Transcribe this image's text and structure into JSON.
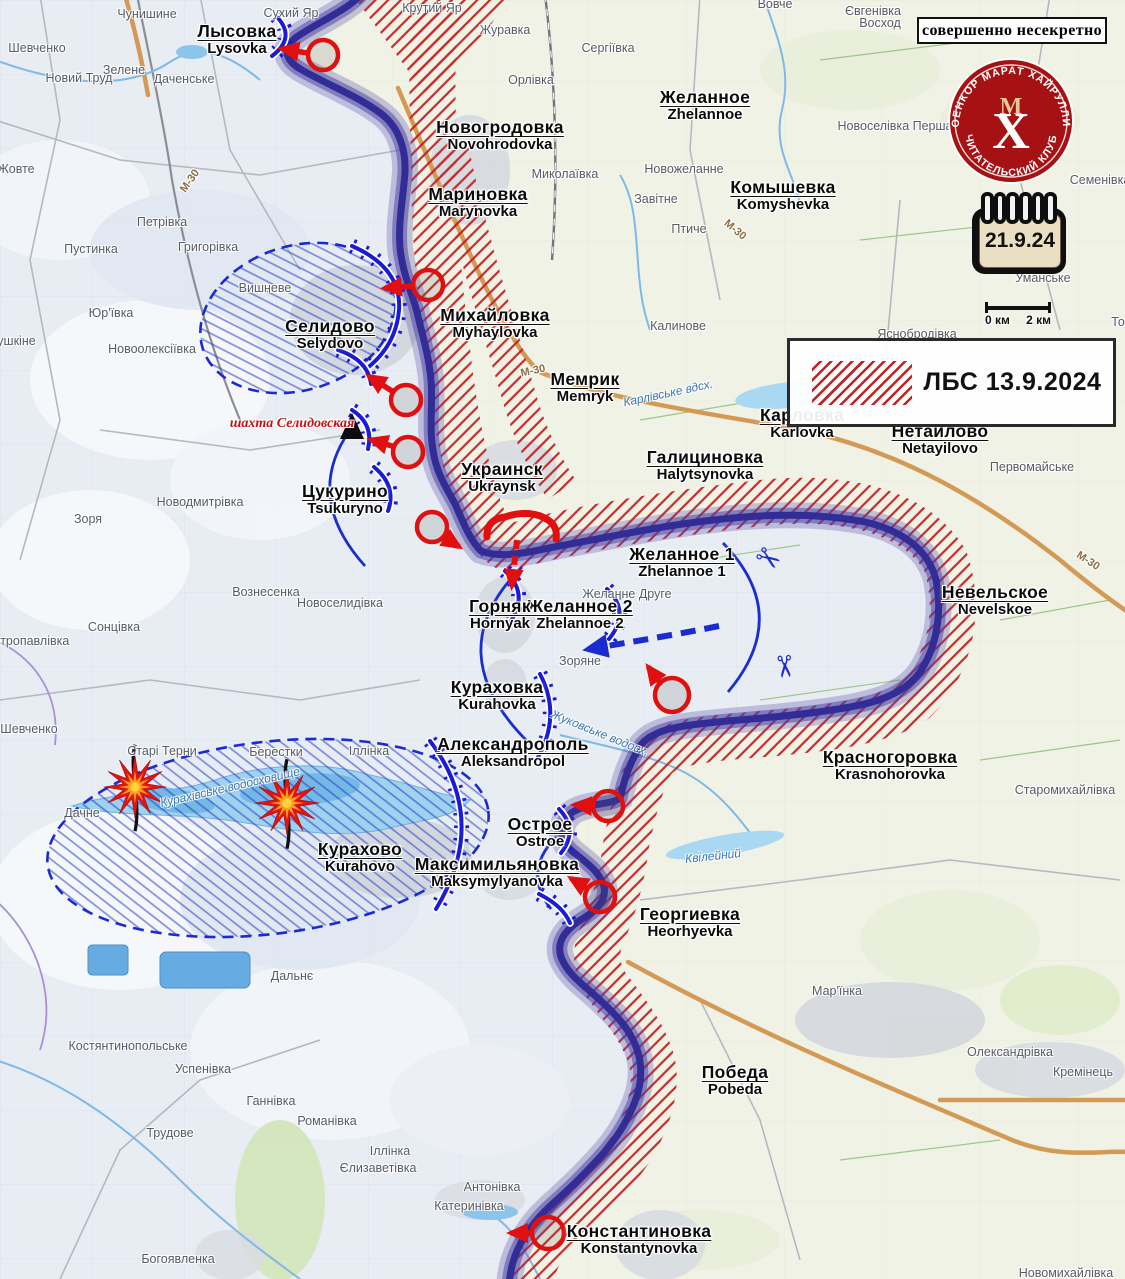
{
  "meta": {
    "classification": "совершенно несекретно"
  },
  "logo": {
    "arc_top": "ВОЕНКОР МАРАТ ХАЙРУЛЛИН",
    "arc_bottom": "• ЧИТАТЕЛЬСКИЙ КЛУБ •",
    "monogram_m": "М",
    "monogram_x": "Х"
  },
  "calendar": {
    "date": "21.9.24"
  },
  "scale": {
    "start": "0 км",
    "end": "2 км"
  },
  "legend": {
    "label": "ЛБС 13.9.2024"
  },
  "mine": {
    "text": "шахта Селидовская"
  },
  "colors": {
    "front_line": "#312c96",
    "enemy_hatch": "#c32222",
    "friendly_blue": "#1b1bd6",
    "attack_red": "#e01010"
  },
  "cities": [
    {
      "ru": "Лысовка",
      "en": "Lysovka",
      "x": 237,
      "y": 22
    },
    {
      "ru": "Новогродовка",
      "en": "Novohrodovka",
      "x": 500,
      "y": 118
    },
    {
      "ru": "Мариновка",
      "en": "Marynovka",
      "x": 478,
      "y": 185
    },
    {
      "ru": "Желанное",
      "en": "Zhelannoe",
      "x": 705,
      "y": 88
    },
    {
      "ru": "Комышевка",
      "en": "Komyshevka",
      "x": 783,
      "y": 178
    },
    {
      "ru": "Михайловка",
      "en": "Myhaylovka",
      "x": 495,
      "y": 306
    },
    {
      "ru": "Мемрик",
      "en": "Memryk",
      "x": 585,
      "y": 370
    },
    {
      "ru": "Карловка",
      "en": "Karlovka",
      "x": 802,
      "y": 406
    },
    {
      "ru": "Нетайлово",
      "en": "Netayilovo",
      "x": 940,
      "y": 422
    },
    {
      "ru": "Галициновка",
      "en": "Halytsynovka",
      "x": 705,
      "y": 448
    },
    {
      "ru": "Селидово",
      "en": "Selydovo",
      "x": 330,
      "y": 317
    },
    {
      "ru": "Украинск",
      "en": "Ukraynsk",
      "x": 502,
      "y": 460
    },
    {
      "ru": "Цукурино",
      "en": "Tsukuryno",
      "x": 345,
      "y": 482
    },
    {
      "ru": "Желанное 1",
      "en": "Zhelannoe 1",
      "x": 682,
      "y": 545
    },
    {
      "ru": "Желанное 2",
      "en": "Zhelannoe 2",
      "x": 580,
      "y": 597
    },
    {
      "ru": "Горняк",
      "en": "Hornyak",
      "x": 500,
      "y": 597
    },
    {
      "ru": "Невельское",
      "en": "Nevelskoe",
      "x": 995,
      "y": 583
    },
    {
      "ru": "Кураховка",
      "en": "Kurahovka",
      "x": 497,
      "y": 678
    },
    {
      "ru": "Александрополь",
      "en": "Aleksandropol",
      "x": 513,
      "y": 735
    },
    {
      "ru": "Красногоровка",
      "en": "Krasnohorovka",
      "x": 890,
      "y": 748
    },
    {
      "ru": "Острое",
      "en": "Ostroe",
      "x": 540,
      "y": 815
    },
    {
      "ru": "Курахово",
      "en": "Kurahovo",
      "x": 360,
      "y": 840
    },
    {
      "ru": "Максимильяновка",
      "en": "Maksymylyanovka",
      "x": 497,
      "y": 855
    },
    {
      "ru": "Георгиевка",
      "en": "Heorhyevka",
      "x": 690,
      "y": 905
    },
    {
      "ru": "Победа",
      "en": "Pobeda",
      "x": 735,
      "y": 1063
    },
    {
      "ru": "Константиновка",
      "en": "Konstantynovka",
      "x": 639,
      "y": 1222
    }
  ],
  "villages": [
    {
      "t": "Шевченко",
      "x": 37,
      "y": 48
    },
    {
      "t": "Чунишине",
      "x": 147,
      "y": 14
    },
    {
      "t": "Сухий Яр",
      "x": 291,
      "y": 13
    },
    {
      "t": "Крутий Яр",
      "x": 432,
      "y": 8
    },
    {
      "t": "Зелене",
      "x": 124,
      "y": 70
    },
    {
      "t": "Новий Труд",
      "x": 79,
      "y": 78
    },
    {
      "t": "Даченське",
      "x": 184,
      "y": 79
    },
    {
      "t": "Жовте",
      "x": 16,
      "y": 169
    },
    {
      "t": "Журавка",
      "x": 505,
      "y": 30
    },
    {
      "t": "Сергіївка",
      "x": 608,
      "y": 48
    },
    {
      "t": "Орлівка",
      "x": 531,
      "y": 80
    },
    {
      "t": "Вовче",
      "x": 775,
      "y": 4
    },
    {
      "t": "Євгенівка",
      "x": 873,
      "y": 11
    },
    {
      "t": "Восход",
      "x": 880,
      "y": 23
    },
    {
      "t": "Новоселівка Перша",
      "x": 895,
      "y": 126
    },
    {
      "t": "Семенівка",
      "x": 1100,
      "y": 180
    },
    {
      "t": "Миколаївка",
      "x": 565,
      "y": 174
    },
    {
      "t": "Новожеланне",
      "x": 684,
      "y": 169
    },
    {
      "t": "Завітне",
      "x": 656,
      "y": 199
    },
    {
      "t": "Птиче",
      "x": 689,
      "y": 229
    },
    {
      "t": "Калинове",
      "x": 678,
      "y": 326
    },
    {
      "t": "Уманське",
      "x": 1043,
      "y": 278
    },
    {
      "t": "Яснобродівка",
      "x": 917,
      "y": 334
    },
    {
      "t": "Тоненьке",
      "x": 1138,
      "y": 322
    },
    {
      "t": "Первомайське",
      "x": 1032,
      "y": 467
    },
    {
      "t": "Петрівка",
      "x": 162,
      "y": 222
    },
    {
      "t": "Пустинка",
      "x": 91,
      "y": 249
    },
    {
      "t": "Григорівка",
      "x": 208,
      "y": 247
    },
    {
      "t": "Вишневе",
      "x": 265,
      "y": 288
    },
    {
      "t": "Юр'ївка",
      "x": 111,
      "y": 313
    },
    {
      "t": "Пушкіне",
      "x": 12,
      "y": 341
    },
    {
      "t": "Новоолексіївка",
      "x": 152,
      "y": 349
    },
    {
      "t": "Новодмитрівка",
      "x": 200,
      "y": 502
    },
    {
      "t": "Зоря",
      "x": 88,
      "y": 519
    },
    {
      "t": "Петропавлівка",
      "x": 27,
      "y": 641
    },
    {
      "t": "Сонцівка",
      "x": 114,
      "y": 627
    },
    {
      "t": "Вознесенка",
      "x": 266,
      "y": 592
    },
    {
      "t": "Новоселидівка",
      "x": 340,
      "y": 603
    },
    {
      "t": "Зоряне",
      "x": 580,
      "y": 661
    },
    {
      "t": "Желанне Друге",
      "x": 627,
      "y": 594
    },
    {
      "t": "Шевченко",
      "x": 29,
      "y": 729
    },
    {
      "t": "Старі Терни",
      "x": 162,
      "y": 751
    },
    {
      "t": "Берестки",
      "x": 276,
      "y": 752
    },
    {
      "t": "Іллінка",
      "x": 369,
      "y": 751
    },
    {
      "t": "Дачне",
      "x": 82,
      "y": 813
    },
    {
      "t": "Старомихайлівка",
      "x": 1065,
      "y": 790
    },
    {
      "t": "Дальнє",
      "x": 292,
      "y": 976
    },
    {
      "t": "Мар'їнка",
      "x": 837,
      "y": 991
    },
    {
      "t": "Олександрівка",
      "x": 1010,
      "y": 1052
    },
    {
      "t": "Кремінець",
      "x": 1083,
      "y": 1072
    },
    {
      "t": "Костянтинопольське",
      "x": 128,
      "y": 1046
    },
    {
      "t": "Успенівка",
      "x": 203,
      "y": 1069
    },
    {
      "t": "Ганнівка",
      "x": 271,
      "y": 1101
    },
    {
      "t": "Романівка",
      "x": 327,
      "y": 1121
    },
    {
      "t": "Трудове",
      "x": 170,
      "y": 1133
    },
    {
      "t": "Іллінка",
      "x": 390,
      "y": 1151
    },
    {
      "t": "Єлизаветівка",
      "x": 378,
      "y": 1168
    },
    {
      "t": "Антонівка",
      "x": 492,
      "y": 1187
    },
    {
      "t": "Катеринівка",
      "x": 469,
      "y": 1206
    },
    {
      "t": "Богоявленка",
      "x": 178,
      "y": 1259
    },
    {
      "t": "Новомихайлівка",
      "x": 1066,
      "y": 1273
    }
  ],
  "water_labels": [
    {
      "t": "Курахівське водосховище",
      "x": 230,
      "y": 787,
      "r": -13
    },
    {
      "t": "Жуковське водосх.",
      "x": 600,
      "y": 733,
      "r": 22
    },
    {
      "t": "Квілейний",
      "x": 713,
      "y": 856,
      "r": -6
    },
    {
      "t": "Карлівське вдсх.",
      "x": 668,
      "y": 393,
      "r": -12
    }
  ],
  "road_labels": [
    {
      "t": "М-30",
      "x": 533,
      "y": 371,
      "r": -12
    },
    {
      "t": "М-30",
      "x": 1088,
      "y": 561,
      "r": 33
    },
    {
      "t": "М-30",
      "x": 190,
      "y": 181,
      "r": -55
    },
    {
      "t": "М-30",
      "x": 735,
      "y": 230,
      "r": 40
    }
  ]
}
